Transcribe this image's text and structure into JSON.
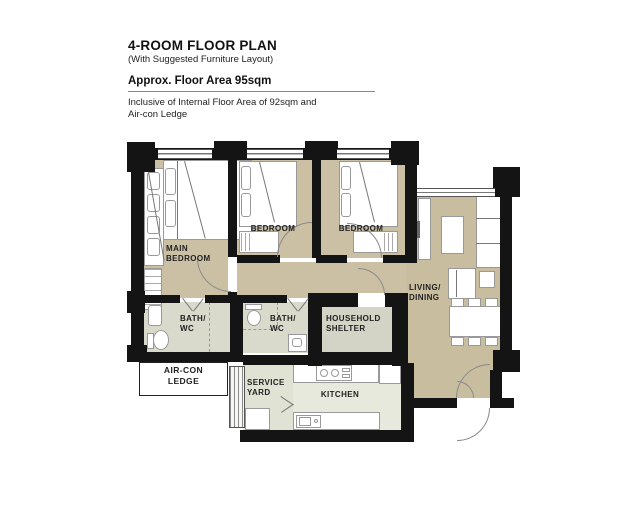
{
  "header": {
    "title": "4-ROOM FLOOR PLAN",
    "subtitle": "(With Suggested Furniture Layout)",
    "area_heading": "Approx. Floor Area 95sqm",
    "note_line1": "Inclusive of Internal Floor Area of 92sqm and",
    "note_line2": "Air-con Ledge"
  },
  "rooms": {
    "main_bedroom": {
      "l1": "MAIN",
      "l2": "BEDROOM"
    },
    "bedroom2": {
      "l1": "BEDROOM"
    },
    "bedroom3": {
      "l1": "BEDROOM"
    },
    "living_dining": {
      "l1": "LIVING/",
      "l2": "DINING"
    },
    "bath1": {
      "l1": "BATH/",
      "l2": "WC"
    },
    "bath2": {
      "l1": "BATH/",
      "l2": "WC"
    },
    "household_shelter": {
      "l1": "HOUSEHOLD",
      "l2": "SHELTER"
    },
    "aircon_ledge": {
      "l1": "AIR-CON",
      "l2": "LEDGE"
    },
    "service_yard": {
      "l1": "SERVICE",
      "l2": "YARD"
    },
    "kitchen": {
      "l1": "KITCHEN"
    }
  },
  "colors": {
    "wall": "#141414",
    "floor_bedroom": "#ccc0a4",
    "floor_living": "#c9bda0",
    "floor_bath": "#d9d9cc",
    "floor_shelter": "#d3d4c6",
    "floor_kitchen": "#e7e9dc",
    "floor_service": "#e0e3d4",
    "furniture_fill": "#ffffff",
    "furniture_stroke": "#999999"
  }
}
